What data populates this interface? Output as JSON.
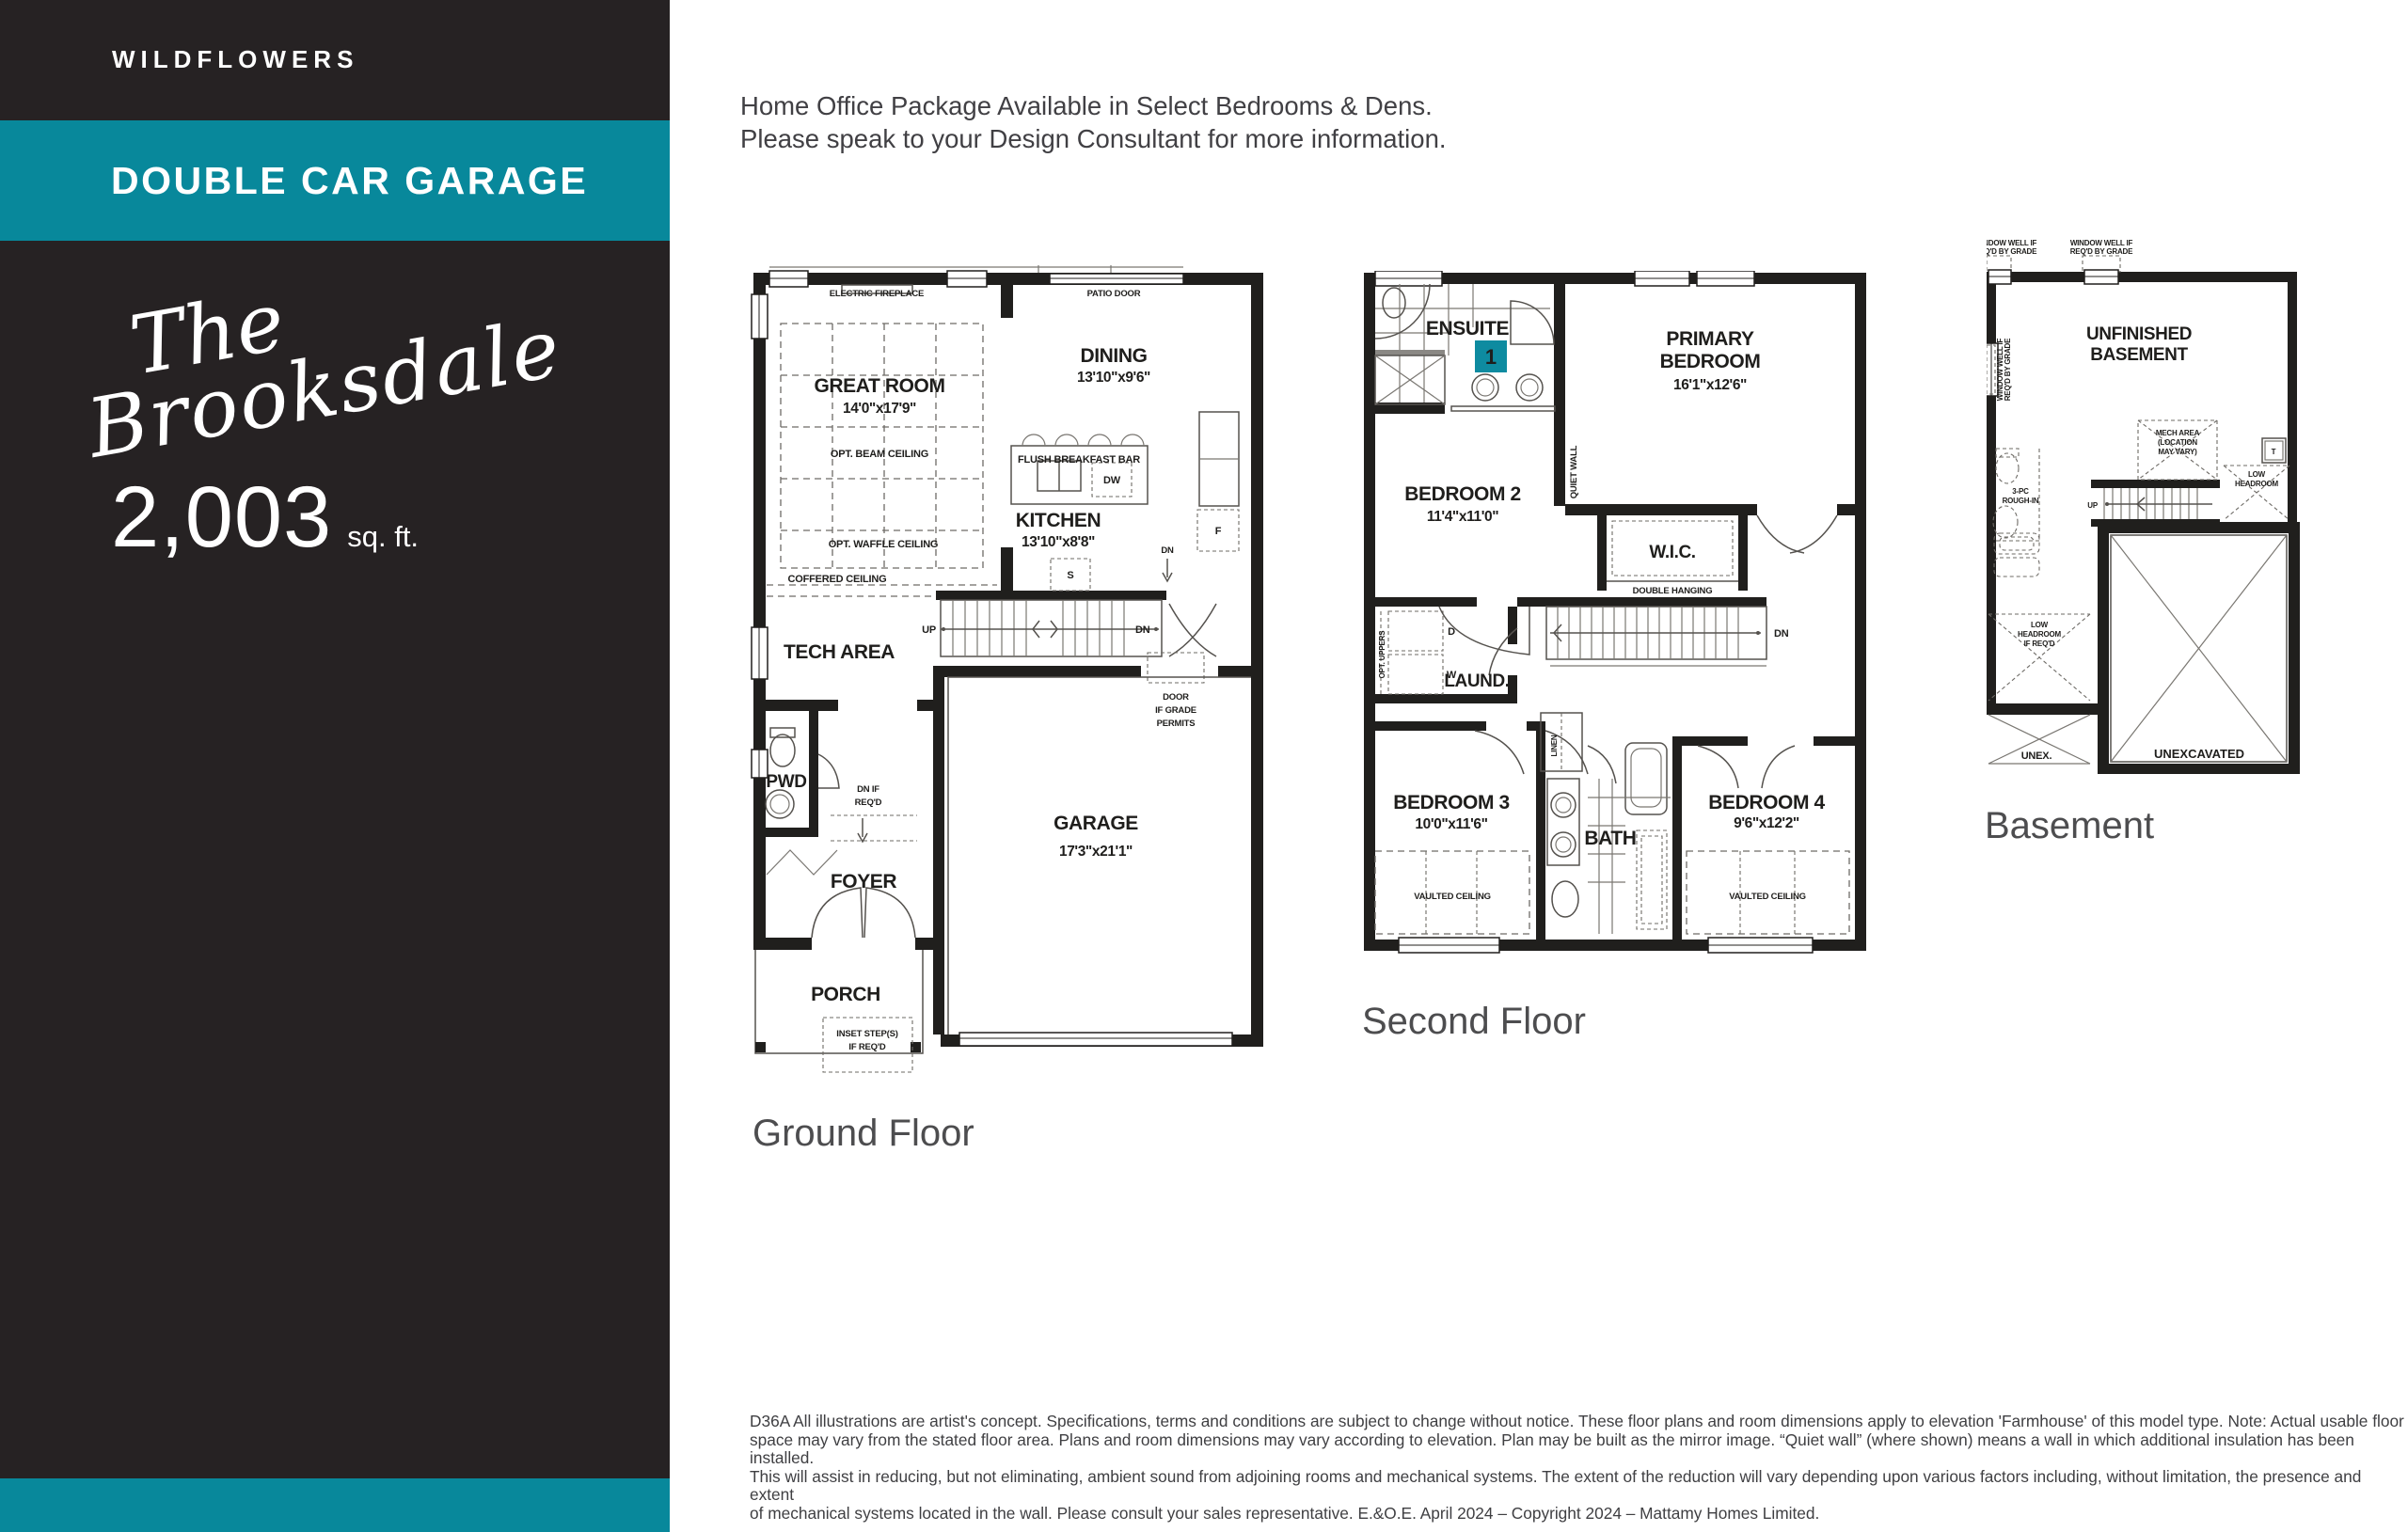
{
  "colors": {
    "teal": "#08889B",
    "sidebar_dark": "#262223",
    "plan_ink": "#1F1E1C",
    "title_gray": "#4D4D4F"
  },
  "sidebar": {
    "community": "WILDFLOWERS",
    "banner": "DOUBLE CAR GARAGE",
    "model_script_line1": "The",
    "model_script_line2": "Brooksdale",
    "sqft_value": "2,003",
    "sqft_unit": "sq. ft."
  },
  "header": {
    "line1": "Home Office Package Available in Select Bedrooms & Dens.",
    "line2": "Please speak to your Design Consultant for more information."
  },
  "plans": {
    "ground": {
      "title": "Ground Floor",
      "labels": {
        "electric_fireplace": "ELECTRIC FIREPLACE",
        "patio_door": "PATIO DOOR",
        "great_room": "GREAT ROOM",
        "great_room_dim": "14'0\"x17'9\"",
        "opt_beam_ceiling": "OPT. BEAM CEILING",
        "opt_waffle_ceiling": "OPT. WAFFLE CEILING",
        "coffered_ceiling": "COFFERED CEILING",
        "dining": "DINING",
        "dining_dim": "13'10\"x9'6\"",
        "flush_breakfast_bar": "FLUSH BREAKFAST BAR",
        "dw": "DW",
        "kitchen": "KITCHEN",
        "kitchen_dim": "13'10\"x8'8\"",
        "fridge": "F",
        "shelf": "S",
        "up": "UP",
        "dn": "DN",
        "dn_vestibule": "DN",
        "tech_area": "TECH AREA",
        "door_grade_1": "DOOR",
        "door_grade_2": "IF GRADE",
        "door_grade_3": "PERMITS",
        "garage": "GARAGE",
        "garage_dim": "17'3\"x21'1\"",
        "pwd": "PWD",
        "dn_if_1": "DN IF",
        "dn_if_2": "REQ'D",
        "foyer": "FOYER",
        "porch": "PORCH",
        "inset_1": "INSET STEP(S)",
        "inset_2": "IF REQ'D"
      }
    },
    "second": {
      "title": "Second Floor",
      "labels": {
        "ensuite": "ENSUITE",
        "badge_1": "1",
        "primary_1": "PRIMARY",
        "primary_2": "BEDROOM",
        "primary_dim": "16'1\"x12'6\"",
        "quiet_wall": "QUIET WALL",
        "bedroom2": "BEDROOM 2",
        "bedroom2_dim": "11'4\"x11'0\"",
        "wic": "W.I.C.",
        "double_hanging": "DOUBLE HANGING",
        "dn": "DN",
        "laund": "LAUND.",
        "d": "D",
        "w": "W",
        "opt_uppers": "OPT. UPPERS",
        "linen": "LINEN",
        "bedroom3": "BEDROOM 3",
        "bedroom3_dim": "10'0\"x11'6\"",
        "bath": "BATH",
        "bedroom4": "BEDROOM 4",
        "bedroom4_dim": "9'6\"x12'2\"",
        "vaulted_ceiling": "VAULTED CEILING"
      }
    },
    "basement": {
      "title": "Basement",
      "labels": {
        "window_well_1": "WINDOW WELL IF",
        "window_well_2": "REQ'D BY GRADE",
        "unfinished_1": "UNFINISHED",
        "unfinished_2": "BASEMENT",
        "mech_1": "MECH AREA",
        "mech_2": "(LOCATION",
        "mech_3": "MAY VARY)",
        "tank": "T",
        "low_1": "LOW",
        "low_2": "HEADROOM",
        "rough_1": "3-PC",
        "rough_2": "ROUGH-IN",
        "up": "UP",
        "lhr_1": "LOW",
        "lhr_2": "HEADROOM",
        "lhr_3": "IF REQ'D",
        "unex": "UNEX.",
        "unexcavated": "UNEXCAVATED"
      }
    }
  },
  "footnote": {
    "line1": "D36A All illustrations are artist's concept. Specifications, terms and conditions are subject to change without notice. These floor plans and room dimensions apply to elevation 'Farmhouse' of this model type. Note: Actual usable floor",
    "line2": "space may vary from the stated floor area. Plans and room dimensions may vary according to elevation. Plan may be built as the mirror image. “Quiet wall” (where shown) means a wall in which additional insulation has been installed.",
    "line3": "This will assist in reducing, but not eliminating, ambient sound from adjoining rooms and mechanical systems. The extent of the reduction will vary depending upon various factors including, without limitation, the presence and extent",
    "line4": "of mechanical systems located in the wall. Please consult your sales representative. E.&O.E. April 2024 – Copyright 2024 – Mattamy Homes Limited."
  }
}
